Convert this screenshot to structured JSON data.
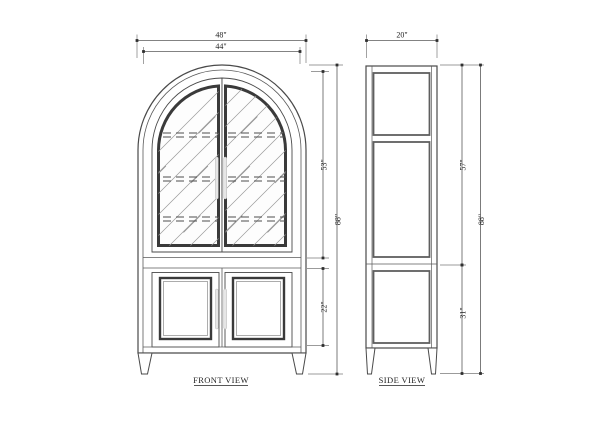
{
  "drawing": {
    "front_view": {
      "label": "FRONT VIEW",
      "dims": {
        "overall_width": "48\"",
        "door_width": "44\"",
        "upper_door_height": "53\"",
        "overall_height": "88\"",
        "lower_door_height": "22\""
      },
      "features": {
        "upper_glass_doors": 2,
        "lower_panel_doors": 2,
        "shelves_shown_dashed": 3
      }
    },
    "side_view": {
      "label": "SIDE VIEW",
      "dims": {
        "depth": "20\"",
        "upper_section_height": "57\"",
        "overall_height": "88\"",
        "lower_section_height": "31\""
      },
      "features": {
        "side_panels": 3
      }
    },
    "colors": {
      "background": "#ffffff",
      "outline": "#4a4a4a",
      "frame_dark": "#3a3a3a",
      "extension_line": "#7a7a7a",
      "hatch": "#999999",
      "handle_fill": "#e6e6e6"
    }
  }
}
